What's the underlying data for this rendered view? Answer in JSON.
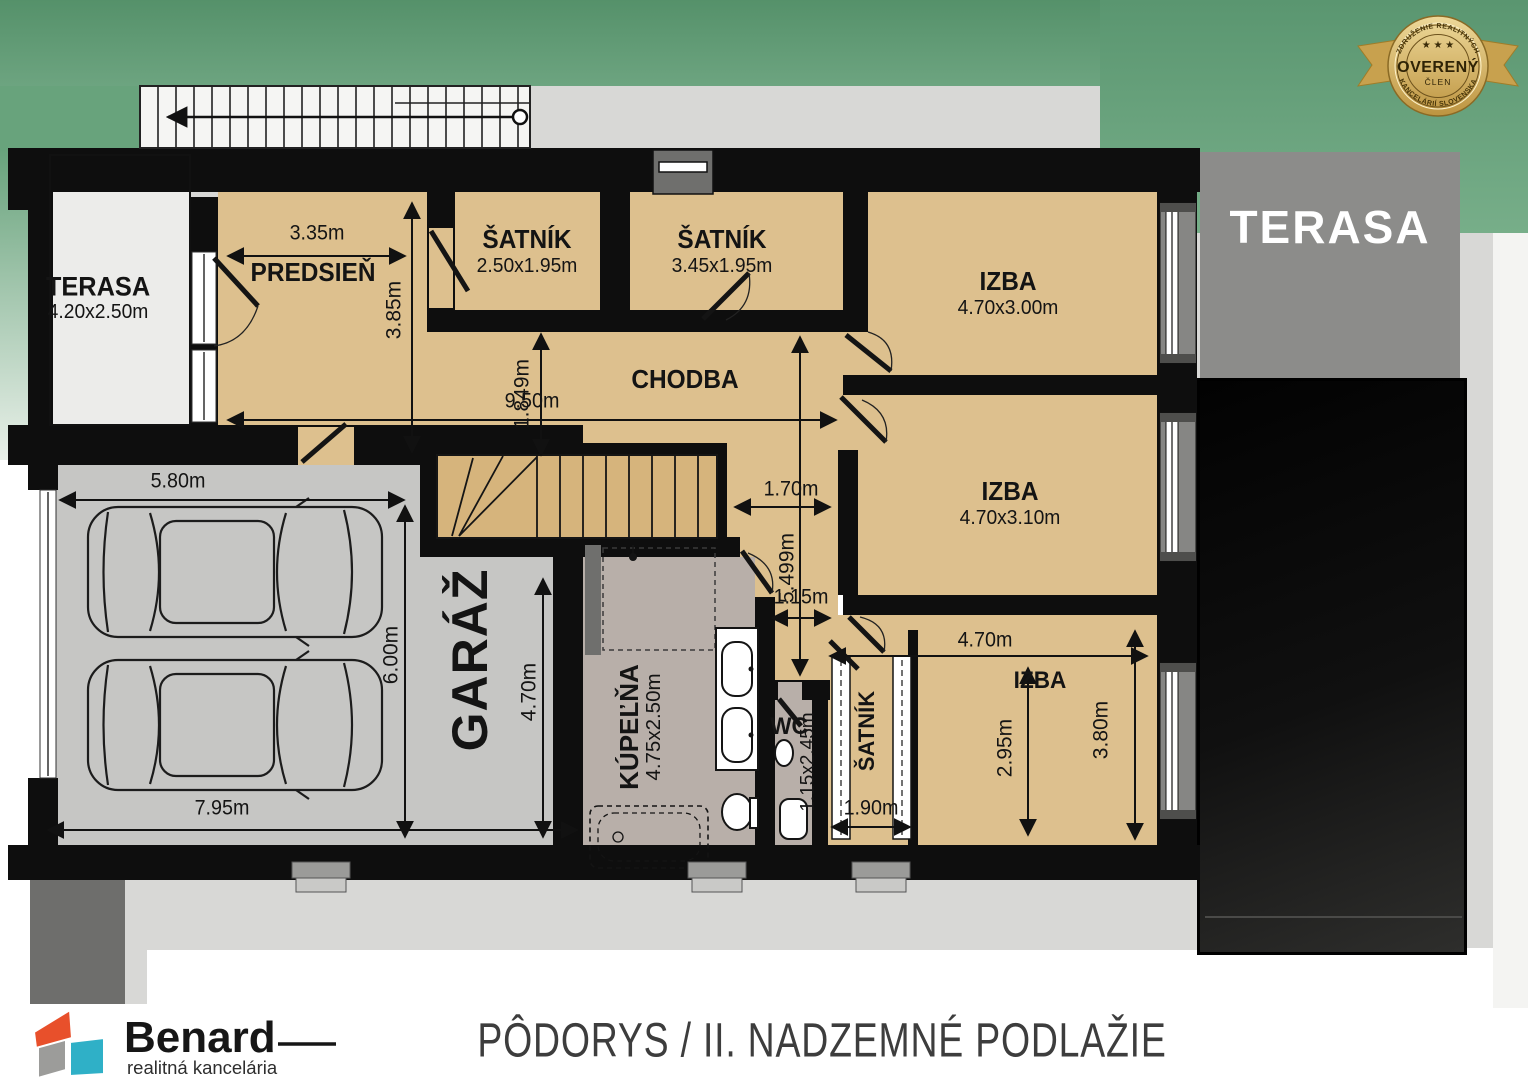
{
  "title": "PÔDORYS / II. NADZEMNÉ PODLAŽIE",
  "badge": {
    "arc_top": "ZDRUŽENIE REALITNÝCH",
    "stars": "★ ★ ★",
    "main": "OVERENÝ",
    "sub": "ČLEN",
    "arc_bottom": "KANCELÁRIÍ SLOVENSKA"
  },
  "logo": {
    "name": "Benard",
    "tagline": "realitná kancelária"
  },
  "rooms": {
    "terasa_left": {
      "name": "TERASA",
      "dims": "4.20x2.50m"
    },
    "predsien": {
      "name": "PREDSIEŇ"
    },
    "satnik1": {
      "name": "ŠATNÍK",
      "dims": "2.50x1.95m"
    },
    "satnik2": {
      "name": "ŠATNÍK",
      "dims": "3.45x1.95m"
    },
    "izba1": {
      "name": "IZBA",
      "dims": "4.70x3.00m"
    },
    "chodba": {
      "name": "CHODBA"
    },
    "izba2": {
      "name": "IZBA",
      "dims": "4.70x3.10m"
    },
    "garaz": {
      "name": "GARÁŽ"
    },
    "kupelna": {
      "name": "KÚPEĽŇA",
      "dims": "4.75x2.50m"
    },
    "wc": {
      "name": "WC",
      "dims": "1.15x2.45m"
    },
    "satnik3": {
      "name": "ŠATNÍK"
    },
    "izba3": {
      "name": "IZBA"
    },
    "terasa_right": {
      "name": "TERASA"
    }
  },
  "dimensions": {
    "predsien_width": "3.35m",
    "predsien_depth": "3.85m",
    "chodba_width": "1.849m",
    "chodba_length": "9.50m",
    "garage_width_top": "5.80m",
    "garage_depth": "6.00m",
    "garage_inner_depth": "4.70m",
    "garage_width_bottom": "7.95m",
    "landing_width": "1.70m",
    "corridor_length": "5.499m",
    "corridor_width": "1.15m",
    "satnik3_width": "1.90m",
    "izba3_width": "4.70m",
    "izba3_depth_inner": "2.95m",
    "izba3_depth": "3.80m"
  },
  "colors": {
    "accent_green": "#68a37c",
    "floor_tan": "#ddc08e",
    "wall": "#0e0e0e",
    "terrace_gray": "#8c8c8a",
    "badge_gold": "#d9b967"
  }
}
